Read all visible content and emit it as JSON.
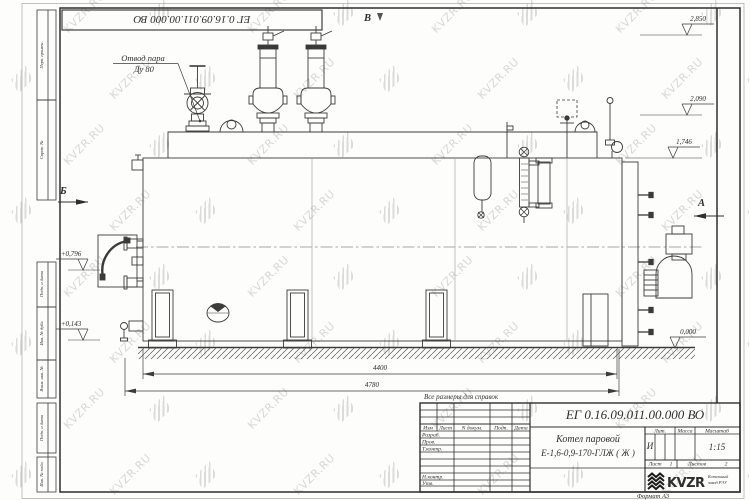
{
  "watermark": {
    "text": "KVZR.RU"
  },
  "frame": {
    "top_stamp": "ЕГ 0.16.09.011.00.000  ВО",
    "margin_blocks": [
      "Перв. примен.",
      "Справ. №",
      "Подп. и дата",
      "Инв. № дубл.",
      "Взам. инв. №",
      "Подп. и дата",
      "Инв. № подл."
    ],
    "format_note": "Формат А3"
  },
  "drawing": {
    "callout": {
      "line1": "Отвод пара",
      "line2": "Ду 80"
    },
    "views": {
      "top": "В",
      "left": "Б",
      "right": "А"
    },
    "elevations": {
      "e2850": "2,850",
      "e2090": "2,090",
      "e1746": "1,746",
      "e0796": "+0,796",
      "e0143": "+0,143",
      "e0000": "0,000"
    },
    "dims": {
      "d4400": "4400",
      "d4780": "4780"
    },
    "note": "Все размеры для справок"
  },
  "title_block": {
    "doc_number": "ЕГ 0.16.09.011.00.000  ВО",
    "name_line1": "Котел паровой",
    "name_line2": "Е-1,6-0,9-170-ГЛЖ ( Ж )",
    "cols": {
      "izm": "Изм",
      "list": "Лист",
      "ndoc": "N докум.",
      "podp": "Подп.",
      "data": "Дата"
    },
    "rows": {
      "razrab": "Разраб.",
      "prov": "Пров.",
      "tkontr": "Т.контр.",
      "nkontr": "Н.контр.",
      "utv": "Утв."
    },
    "lit_header": "Лит.",
    "mass_header": "Масса",
    "scale_header": "Масштаб",
    "lit_value": "И",
    "scale_value": "1:15",
    "sheet_label": "Лист",
    "sheet_value": "1",
    "sheets_label": "Листов",
    "sheets_value": "2",
    "logo_text": "KVZR",
    "logo_sub1": "Котельный",
    "logo_sub2": "завод РЭУ"
  }
}
